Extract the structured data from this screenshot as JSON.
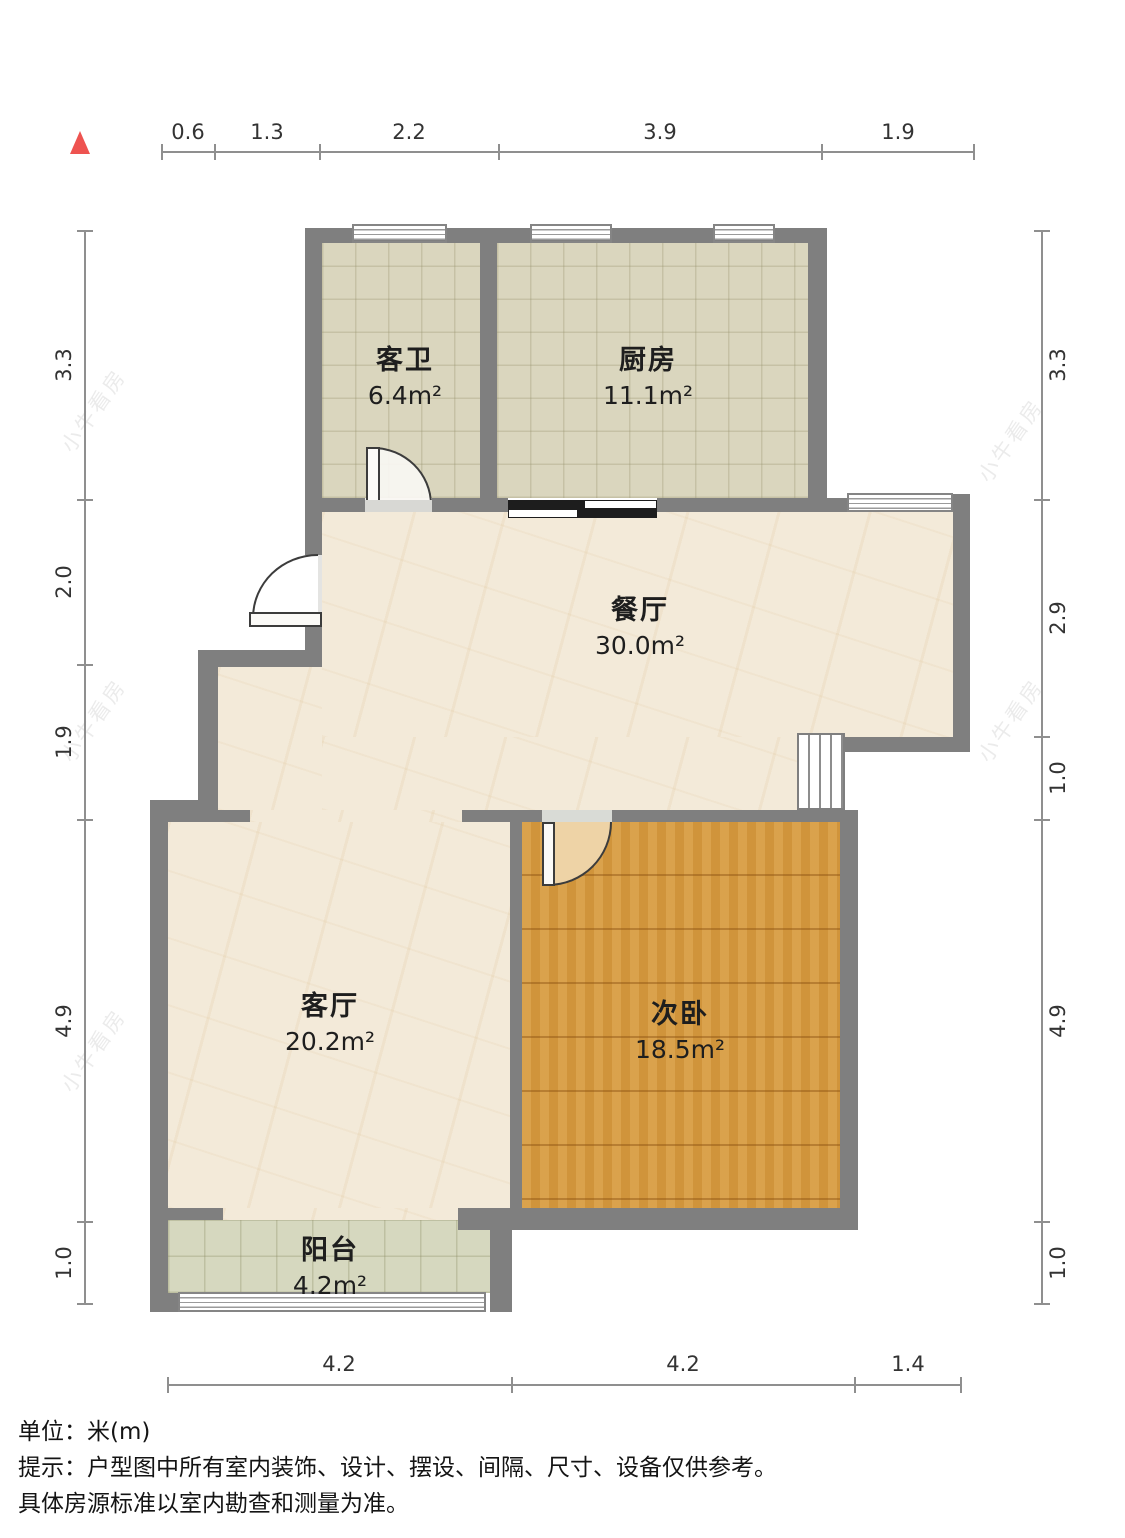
{
  "plan": {
    "rooms": [
      {
        "name": "客卫",
        "area": "6.4m²"
      },
      {
        "name": "厨房",
        "area": "11.1m²"
      },
      {
        "name": "餐厅",
        "area": "30.0m²"
      },
      {
        "name": "客厅",
        "area": "20.2m²"
      },
      {
        "name": "次卧",
        "area": "18.5m²"
      },
      {
        "name": "阳台",
        "area": "4.2m²"
      }
    ]
  },
  "dimensions": {
    "top": [
      "0.6",
      "1.3",
      "2.2",
      "3.9",
      "1.9"
    ],
    "left": [
      "3.3",
      "2.0",
      "1.9",
      "4.9",
      "1.0"
    ],
    "right": [
      "3.3",
      "2.9",
      "1.0",
      "4.9",
      "1.0"
    ],
    "bottom": [
      "4.2",
      "4.2",
      "1.4"
    ]
  },
  "footer": {
    "line1": "单位：米(m)",
    "line2": "提示：户型图中所有室内装饰、设计、摆设、间隔、尺寸、设备仅供参考。",
    "line3": "具体房源标准以室内勘查和测量为准。"
  },
  "watermark": {
    "text": "小牛看房"
  },
  "colors": {
    "wall": "#7f7f7f",
    "tile_floor": "#dad6be",
    "marble_floor": "#f3ead9",
    "wood_floor": "#d79b3f",
    "balcony_floor": "#d6d8bf",
    "north_arrow": "#ee5350"
  }
}
